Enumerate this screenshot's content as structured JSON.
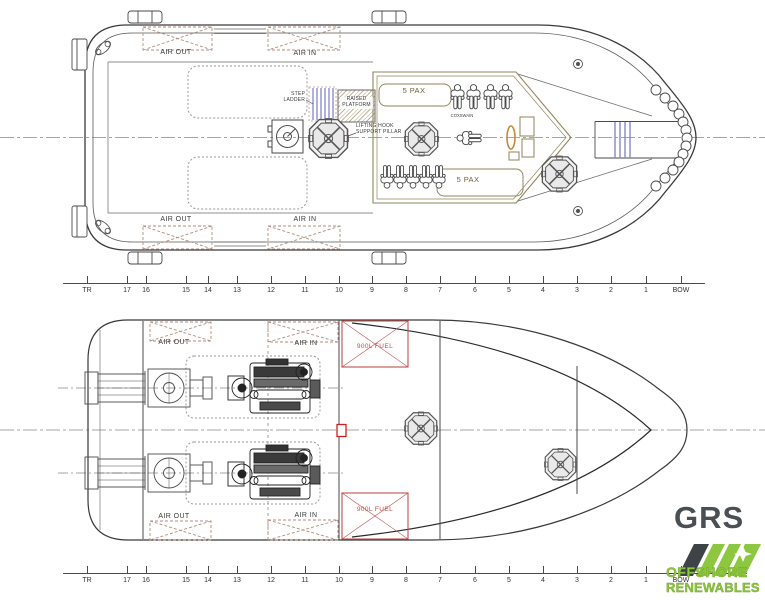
{
  "colors": {
    "line": "#3a3a3a",
    "cabin_olive": "#8f865c",
    "vent_dash": "#b08d7d",
    "lift_red": "#cc2020",
    "fuel_red": "#c0504d",
    "ladder_blue": "#8585cc",
    "wheel_orange": "#c8883a",
    "logo_green": "#8dc63f",
    "logo_gray": "#4a4f54"
  },
  "upper_deck": {
    "vents": {
      "air_out": "AIR OUT",
      "air_in": "AIR IN"
    },
    "pax_fwd": "5 PAX",
    "pax_aft": "5 PAX",
    "step_ladder_line1": "STEP",
    "step_ladder_line2": "LADDER",
    "raised_platform_line1": "RAISED",
    "raised_platform_line2": "PLATFORM",
    "lifting_hook_line1": "LIFTING HOOK",
    "lifting_hook_line2": "SUPPORT PILLAR",
    "coxswain": "COXSWAIN"
  },
  "lower_deck": {
    "vents": {
      "air_out": "AIR OUT",
      "air_in": "AIR IN"
    },
    "fuel_tank_fwd": "900L FUEL",
    "fuel_tank_aft": "900L FUEL"
  },
  "rulers": {
    "stations": [
      "TR",
      "17",
      "16",
      "15",
      "14",
      "13",
      "12",
      "11",
      "10",
      "9",
      "8",
      "7",
      "6",
      "5",
      "4",
      "3",
      "2",
      "1",
      "BOW"
    ]
  },
  "logo": {
    "brand": "GRS",
    "line1": "OFFSHORE",
    "line2": "RENEWABLES"
  }
}
